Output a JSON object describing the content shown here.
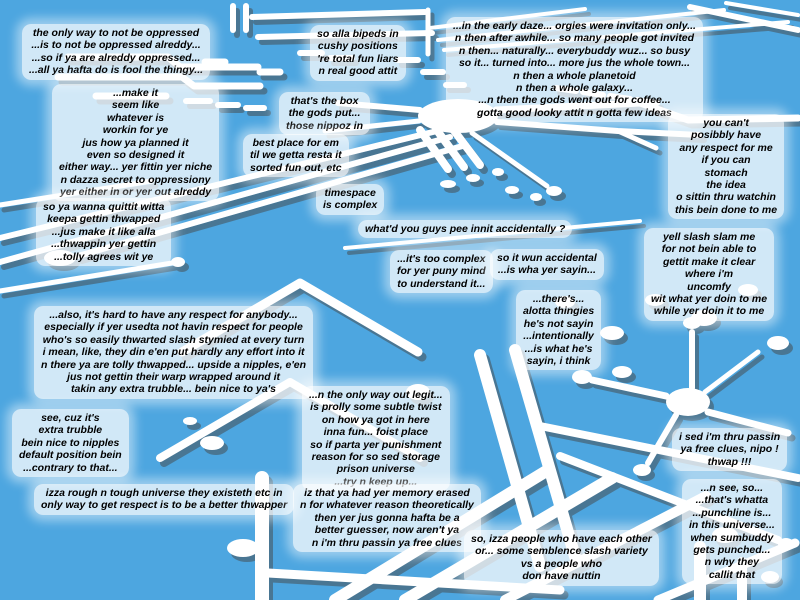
{
  "scene": {
    "background_color": "#4da6e0",
    "trace_color": "#ffffff",
    "trace_shadow_color": "rgba(70,70,70,0.5)",
    "text_color": "#000000",
    "box_background": "rgba(255,255,255,0.74)"
  },
  "boxes": {
    "oppressed": {
      "text": "the only way to not be oppressed\n...is to not be oppressed alreddy...\n...so if ya are alreddy oppressed...\n...all ya hafta do is fool the thingy..."
    },
    "make_it_seem": {
      "text": "...make it\nseem like\nwhatever is\nworkin for ye\njus how ya planned it\neven so designed it\neither way... yer fittin yer niche\nn dazza secret to oppressiony\nyer either in or yer out alreddy"
    },
    "quittit": {
      "text": "so ya wanna quittit witta\nkeepa gettin thwapped\n...jus make it like alla\n...thwappin yer gettin\n...tolly agrees wit ye"
    },
    "bipeds": {
      "text": "so alla bipeds in\ncushy positions\n're total fun liars\nn real good attit"
    },
    "gods_box": {
      "text": "that's the box\nthe gods put...\nthose nippoz in"
    },
    "best_place": {
      "text": "best place for em\ntil we getta resta it\nsorted fun out, etc"
    },
    "timespace": {
      "text": "timespace\nis complex"
    },
    "early_daze": {
      "text": "...in the early daze... orgies were invitation only...\nn then after awhile... so many people got invited\nn then... naturally... everybuddy wuz... so busy\nso it... turned into... more jus the whole town...\nn then a whole planetoid\nn then a whole galaxy...\n...n then the gods went out for coffee...\ngotta good looky attit n gotta few ideas"
    },
    "no_respect": {
      "text": "you can't\nposibbly have\nany respect for me\nif you can\nstomach\nthe idea\no sittin thru watchin\nthis bein done to me"
    },
    "pee_innit": {
      "text": "what'd you guys pee innit accidentally ?"
    },
    "yell_slash": {
      "text": "yell slash slam me\nfor not bein able to\ngettit make it clear\nwhere i'm\nuncomfy\nwit what yer doin to me\nwhile yer doin it to me"
    },
    "too_complex": {
      "text": "...it's too complex\nfor yer puny mind\nto understand it..."
    },
    "wun_accidental": {
      "text": "so it wun accidental\n...is wha yer sayin..."
    },
    "thingies": {
      "text": "...there's...\nalotta thingies\nhe's not sayin\n...intentionally\n...is what he's\nsayin, i think"
    },
    "hard_respect": {
      "text": "...also, it's hard to have any respect for anybody...\nespecially if yer usedta not havin respect for people\nwho's so easily thwarted slash stymied at every turn\ni mean, like, they din e'en put hardly any effort into it\nn there ya are tolly thwapped... upside a nipples, e'en\njus not gettin their warp wrapped around it\ntakin any extra trubble... bein nice to ya's"
    },
    "extra_trubble": {
      "text": "see, cuz it's\nextra trubble\nbein nice to nipples\ndefault position bein\n...contrary to that..."
    },
    "way_out": {
      "text": "...n the only way out legit...\nis prolly some subtle twist\non how ya got in here\ninna fun... foist place\nso if parta yer punishment\nreason for so sed storage\nprison universe\n...try n keep up..."
    },
    "rough_universe": {
      "text": "izza rough n tough universe they existeth etc in\nonly way to get respect is to be a better thwapper"
    },
    "memory_erased": {
      "text": "iz that ya had yer memory erased\nn for whatever reason theoretically\nthen yer jus gonna hafta be a\nbetter guesser, now aren't ya\nn i'm thru passin ya free clues"
    },
    "free_clues": {
      "text": "i sed i'm thru passin\nya free clues, nipo !\nthwap !!!"
    },
    "punchline": {
      "text": "...n see, so...\n...that's whatta\n...punchline is...\nin this universe...\nwhen sumbuddy\ngets punched...\nn why they\ncallit that"
    },
    "semblence": {
      "text": "so, izza people who have each other\nor... some semblence slash variety\nvs a people who\ndon have nuttin"
    }
  }
}
